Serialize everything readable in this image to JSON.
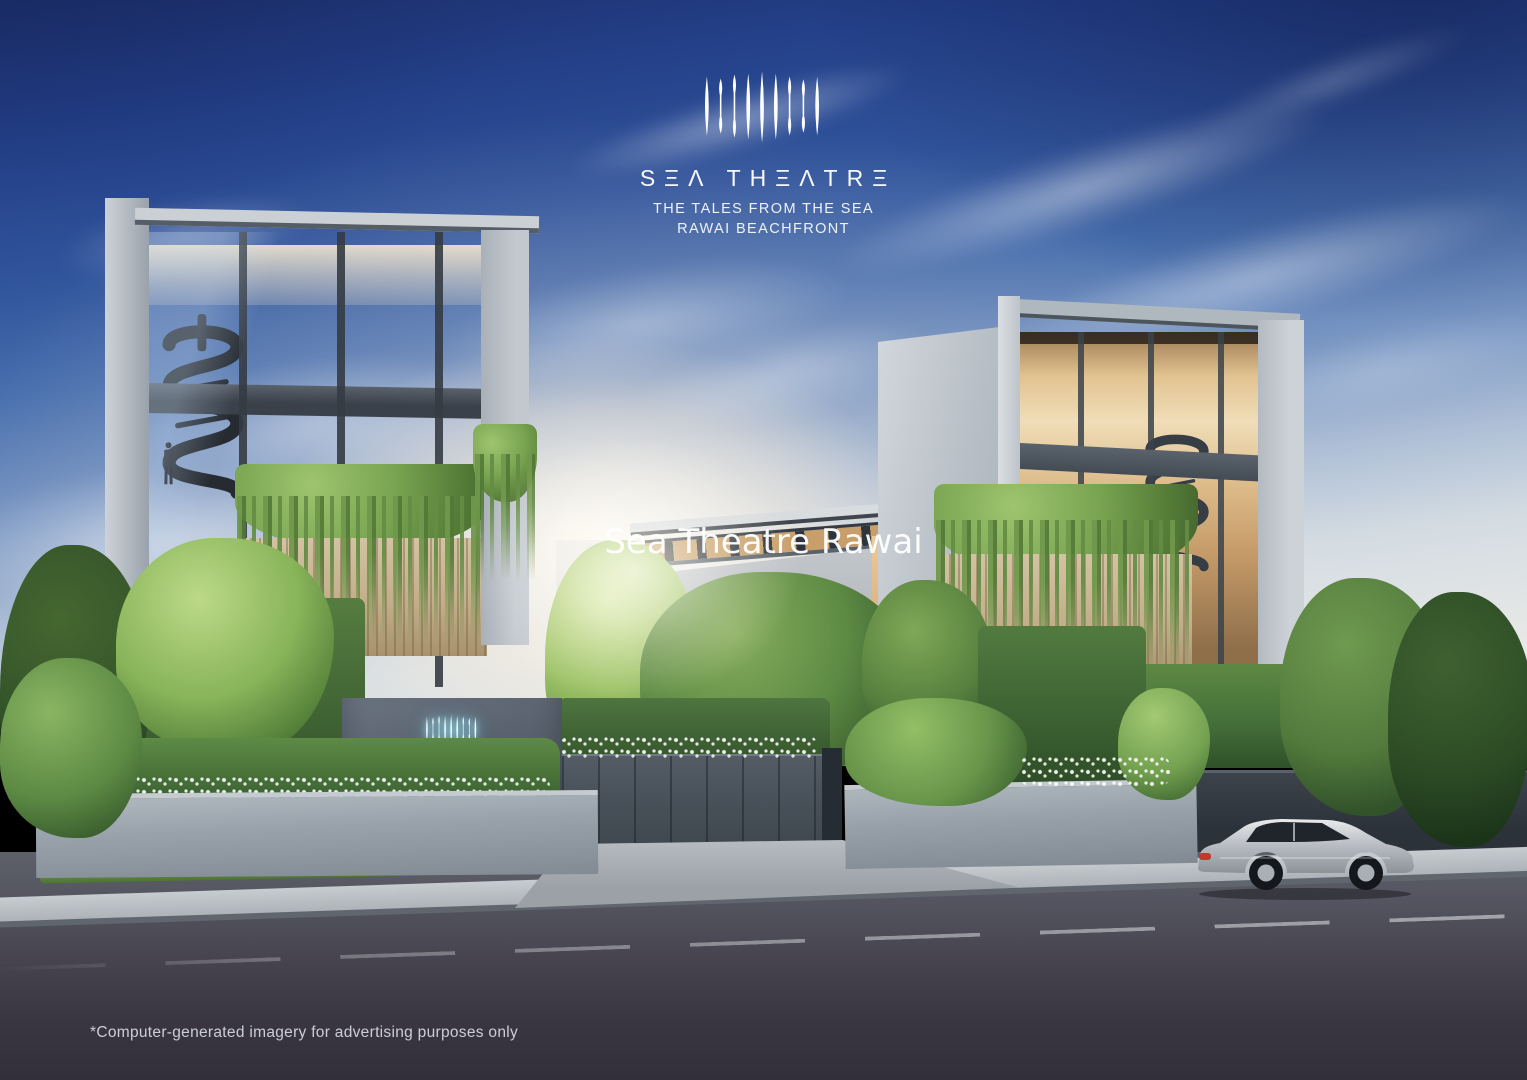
{
  "branding": {
    "logo_mark_name": "sea-theatre-logo-mark",
    "wordmark_display": "SΞΛ THΞΛTRΞ",
    "wordmark_text": "SEA THEATRE",
    "tagline_line1": "THE TALES FROM THE SEA",
    "tagline_line2": "RAWAI BEACHFRONT",
    "text_color": "#ffffff"
  },
  "watermark": {
    "text": "Sea Theatre Rawai"
  },
  "entrance_sign": {
    "logo_mark_name": "sea-theatre-neon-logo-mark",
    "text_display": "SΞΛ THΞΛTRΞ",
    "text": "SEA THEATRE",
    "neon_color": "#bdf3ff",
    "wall_color": "#565f6b"
  },
  "disclaimer": {
    "text": "*Computer-generated imagery for advertising purposes only"
  },
  "scene": {
    "description_colors": {
      "sky_top": "#1c2d68",
      "sky_horizon": "#e9e9e7",
      "sun_glow": "#fff8ec",
      "concrete": "#b9c0c7",
      "warm_interior_light": "#ecd2a4",
      "foliage": "#6f9a4e",
      "wood_slats": "#c9b690",
      "gate": "#4a525b",
      "road": "#3a3843",
      "car_body": "#c6c9cd",
      "car_taillight": "#c0392b"
    }
  }
}
